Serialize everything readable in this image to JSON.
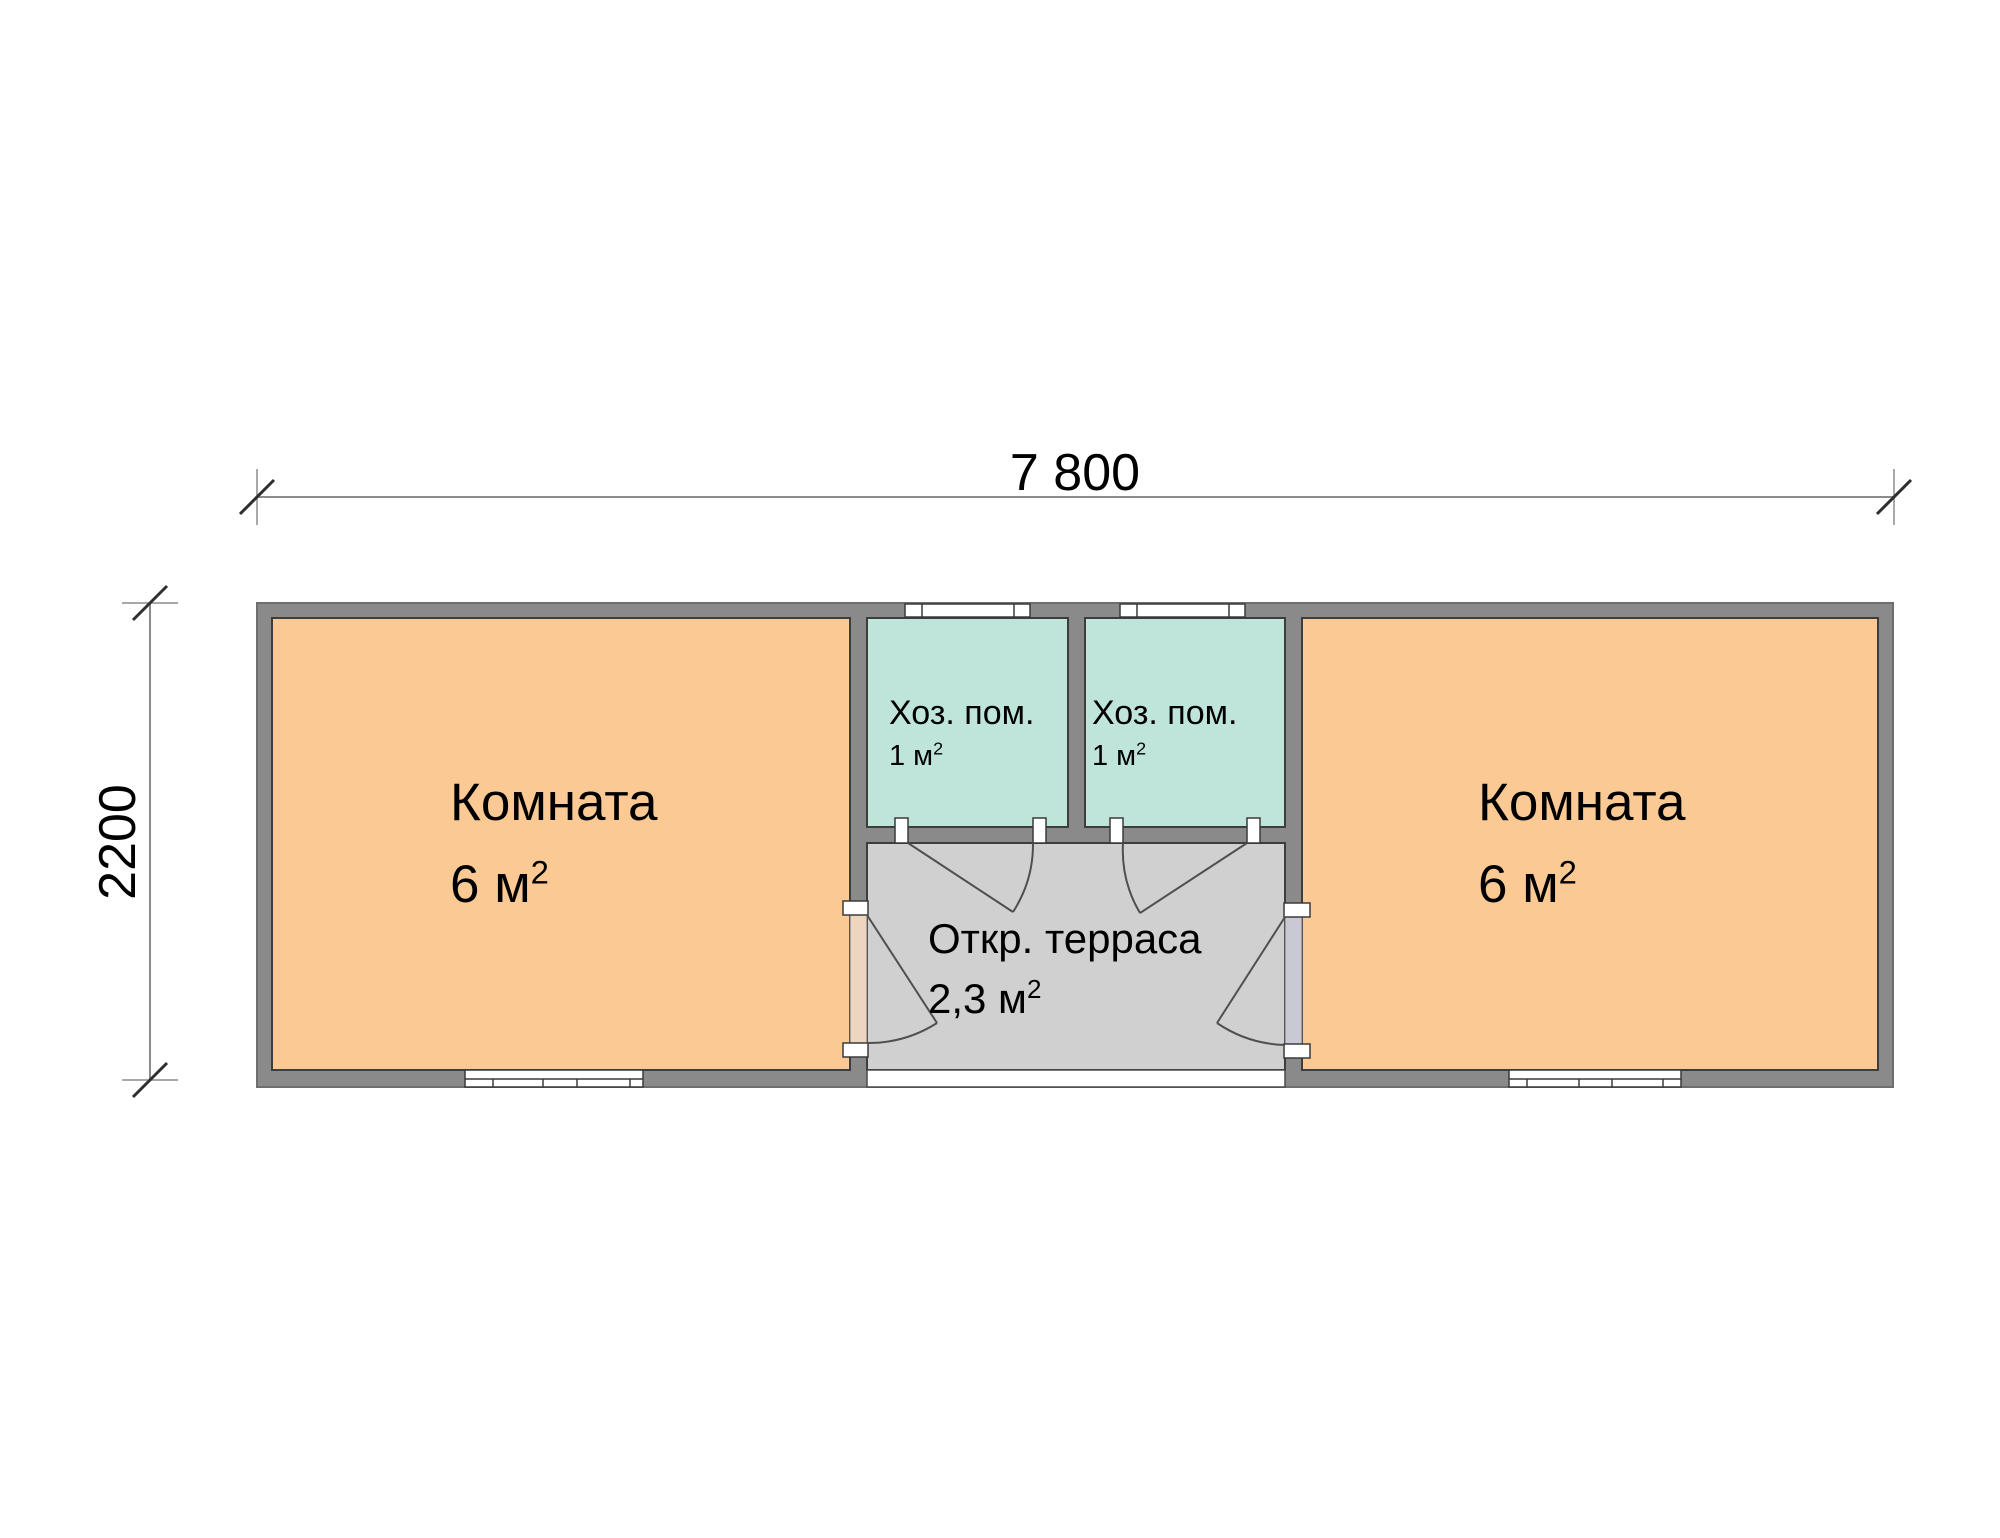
{
  "dimensions": {
    "width_label": "7 800",
    "height_label": "2200"
  },
  "rooms": {
    "left_room": {
      "name": "Комната",
      "area": "6 м",
      "area_sup": "2"
    },
    "right_room": {
      "name": "Комната",
      "area": "6 м",
      "area_sup": "2"
    },
    "utility_left": {
      "name": "Хоз. пом.",
      "area": "1 м",
      "area_sup": "2"
    },
    "utility_right": {
      "name": "Хоз. пом.",
      "area": "1 м",
      "area_sup": "2"
    },
    "terrace": {
      "name": "Откр. терраса",
      "area": "2,3 м",
      "area_sup": "2"
    }
  },
  "colors": {
    "wall": "#8a8a8a",
    "room_fill": "#fbca94",
    "utility_fill": "#bfe5da",
    "terrace_fill": "#d0d0d0",
    "opening_left": "#ecd6bf",
    "opening_right": "#c9c9d4",
    "window_fill": "#ffffff",
    "dimension_line": "#8c8c8c",
    "text": "#000000"
  }
}
